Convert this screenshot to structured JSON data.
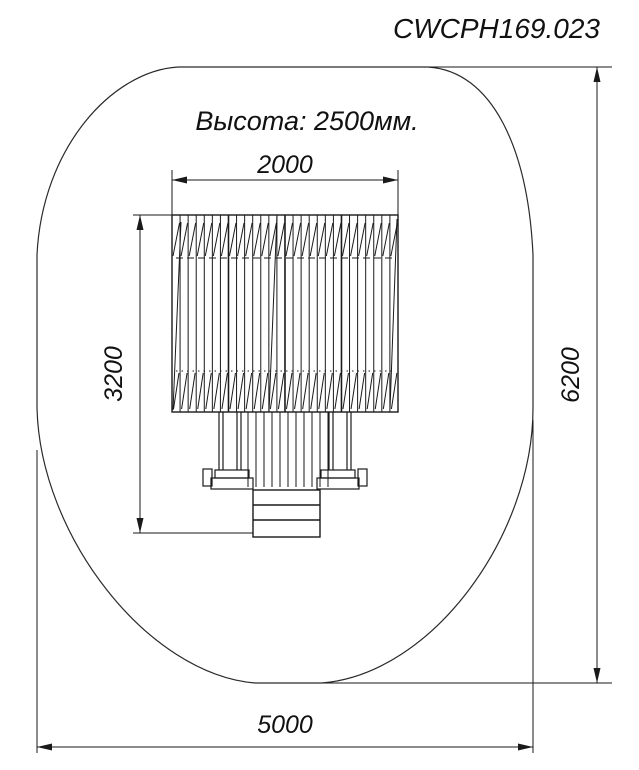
{
  "title": "CWCPH169.023",
  "note": "Высота: 2500мм.",
  "dimensions": {
    "width_top": "2000",
    "height_left": "3200",
    "height_right": "6200",
    "width_bottom": "5000"
  },
  "colors": {
    "line": "#1a1a1a",
    "background": "#ffffff"
  }
}
